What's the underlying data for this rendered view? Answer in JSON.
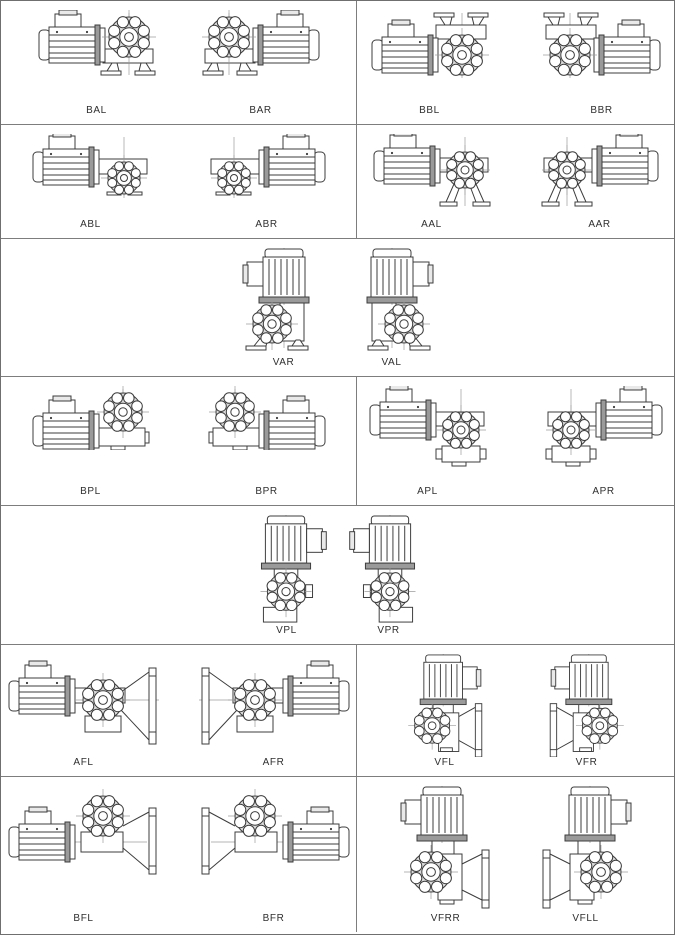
{
  "sheet": {
    "title": "gearmotor-mounting-positions",
    "background_color": "#ffffff",
    "grid_line_color": "#7d7d7d",
    "drawing_line_color": "#3c3c3c",
    "label_color": "#2f2f2f",
    "rows": [
      {
        "cells": [
          {
            "figures": [
              {
                "label": "BAL",
                "kind": "b-foot",
                "mirror": false,
                "icon": "gearmotor-foot-down-motor-left-icon"
              },
              {
                "label": "BAR",
                "kind": "b-foot",
                "mirror": true,
                "icon": "gearmotor-foot-down-motor-right-icon"
              }
            ]
          },
          {
            "figures": [
              {
                "label": "BBL",
                "kind": "b-foot-up",
                "mirror": false,
                "icon": "gearmotor-foot-up-motor-left-icon"
              },
              {
                "label": "BBR",
                "kind": "b-foot-up",
                "mirror": true,
                "icon": "gearmotor-foot-up-motor-right-icon"
              }
            ]
          }
        ]
      },
      {
        "cells": [
          {
            "figures": [
              {
                "label": "ABL",
                "kind": "a-shaft-down",
                "mirror": false,
                "icon": "gearmotor-output-down-motor-left-icon"
              },
              {
                "label": "ABR",
                "kind": "a-shaft-down",
                "mirror": true,
                "icon": "gearmotor-output-down-motor-right-icon"
              }
            ]
          },
          {
            "figures": [
              {
                "label": "AAL",
                "kind": "a-stilts",
                "mirror": false,
                "icon": "gearmotor-legs-motor-left-icon"
              },
              {
                "label": "AAR",
                "kind": "a-stilts",
                "mirror": true,
                "icon": "gearmotor-legs-motor-right-icon"
              }
            ]
          }
        ]
      },
      {
        "cells": [
          {
            "figures": [
              {
                "label": "VAR",
                "kind": "v-foot",
                "mirror": false,
                "icon": "gearmotor-vertical-foot-icon"
              },
              {
                "label": "VAL",
                "kind": "v-foot",
                "mirror": true,
                "icon": "gearmotor-vertical-foot-mirrored-icon"
              }
            ]
          }
        ]
      },
      {
        "cells": [
          {
            "figures": [
              {
                "label": "BPL",
                "kind": "b-pendular",
                "mirror": false,
                "icon": "gearmotor-pendular-motor-left-icon"
              },
              {
                "label": "BPR",
                "kind": "b-pendular",
                "mirror": true,
                "icon": "gearmotor-pendular-motor-right-icon"
              }
            ]
          },
          {
            "figures": [
              {
                "label": "APL",
                "kind": "a-pendular",
                "mirror": false,
                "icon": "gearmotor-pendular-high-motor-left-icon"
              },
              {
                "label": "APR",
                "kind": "a-pendular",
                "mirror": true,
                "icon": "gearmotor-pendular-high-motor-right-icon"
              }
            ]
          }
        ]
      },
      {
        "cells": [
          {
            "figures": [
              {
                "label": "VPL",
                "kind": "v-pendular",
                "mirror": false,
                "icon": "gearmotor-vertical-pendular-icon"
              },
              {
                "label": "VPR",
                "kind": "v-pendular",
                "mirror": true,
                "icon": "gearmotor-vertical-pendular-mirrored-icon"
              }
            ]
          }
        ]
      },
      {
        "cells": [
          {
            "figures": [
              {
                "label": "AFL",
                "kind": "a-flange",
                "mirror": false,
                "icon": "gearmotor-flange-right-motor-left-icon"
              },
              {
                "label": "AFR",
                "kind": "a-flange",
                "mirror": true,
                "icon": "gearmotor-flange-left-motor-right-icon"
              }
            ]
          },
          {
            "figures": [
              {
                "label": "VFL",
                "kind": "v-flange",
                "mirror": false,
                "icon": "gearmotor-vertical-flange-right-icon"
              },
              {
                "label": "VFR",
                "kind": "v-flange",
                "mirror": true,
                "icon": "gearmotor-vertical-flange-left-icon"
              }
            ]
          }
        ]
      },
      {
        "cells": [
          {
            "figures": [
              {
                "label": "BFL",
                "kind": "b-flange",
                "mirror": false,
                "icon": "gearmotor-flange-high-motor-left-icon"
              },
              {
                "label": "BFR",
                "kind": "b-flange",
                "mirror": true,
                "icon": "gearmotor-flange-high-motor-right-icon"
              }
            ]
          },
          {
            "figures": [
              {
                "label": "VFRR",
                "kind": "v-flange-long",
                "mirror": false,
                "icon": "gearmotor-vertical-flange-long-icon"
              },
              {
                "label": "VFLL",
                "kind": "v-flange-long",
                "mirror": true,
                "icon": "gearmotor-vertical-flange-long-mirrored-icon"
              }
            ]
          }
        ]
      }
    ]
  }
}
